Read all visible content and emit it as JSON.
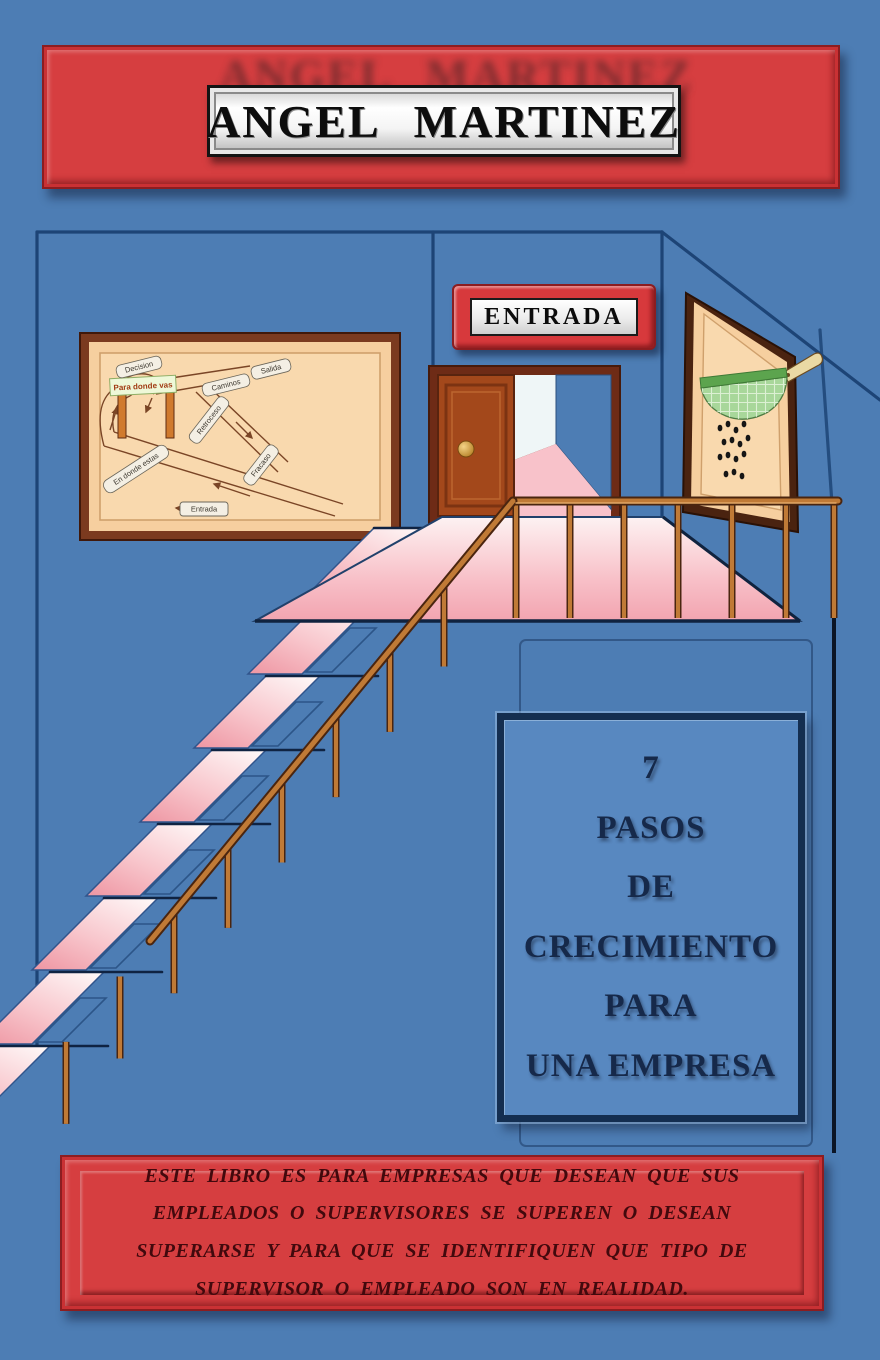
{
  "cover": {
    "author": "ANGEL MARTINEZ",
    "entrance_sign": "ENTRADA",
    "title": {
      "lines": [
        "7",
        "PASOS",
        "DE",
        "CRECIMIENTO",
        "PARA",
        "UNA EMPRESA"
      ]
    },
    "blurb": "ESTE LIBRO ES PARA EMPRESAS QUE DESEAN QUE SUS EMPLEADOS O SUPERVISORES SE SUPEREN O DESEAN SUPERARSE Y PARA QUE SE IDENTIFIQUEN QUE TIPO DE SUPERVISOR O EMPLEADO SON EN REALIDAD."
  },
  "map": {
    "labels": {
      "decision": "Decision",
      "para_donde_vas": "Para donde vas",
      "caminos": "Caminos",
      "salida": "Salida",
      "retroceso": "Retroceso",
      "fracaso": "Fracaso",
      "en_donde_estas": "En donde estas",
      "entrada": "Entrada"
    }
  },
  "scene": {
    "stairs": {
      "count": 8
    },
    "colors": {
      "background": "#4d7db4",
      "wall_line": "#1d4476",
      "banner_red": "#d63e40",
      "tread_outline": "#31558c",
      "tread_shadow": "#0f2342",
      "inset_line": "#2c5588",
      "rail_copper": "#c07a36",
      "rail_dark": "#4a250f",
      "panel_blue": "#5888c0",
      "panel_border": "#142e50",
      "frame_brown": "#7b3a1f",
      "map_tan": "#f6cf9f",
      "door_brown": "#a3481b",
      "strainer_green": "#a8d79a",
      "text_navy": "#16294a",
      "blurb_maroon": "#42090d"
    }
  }
}
